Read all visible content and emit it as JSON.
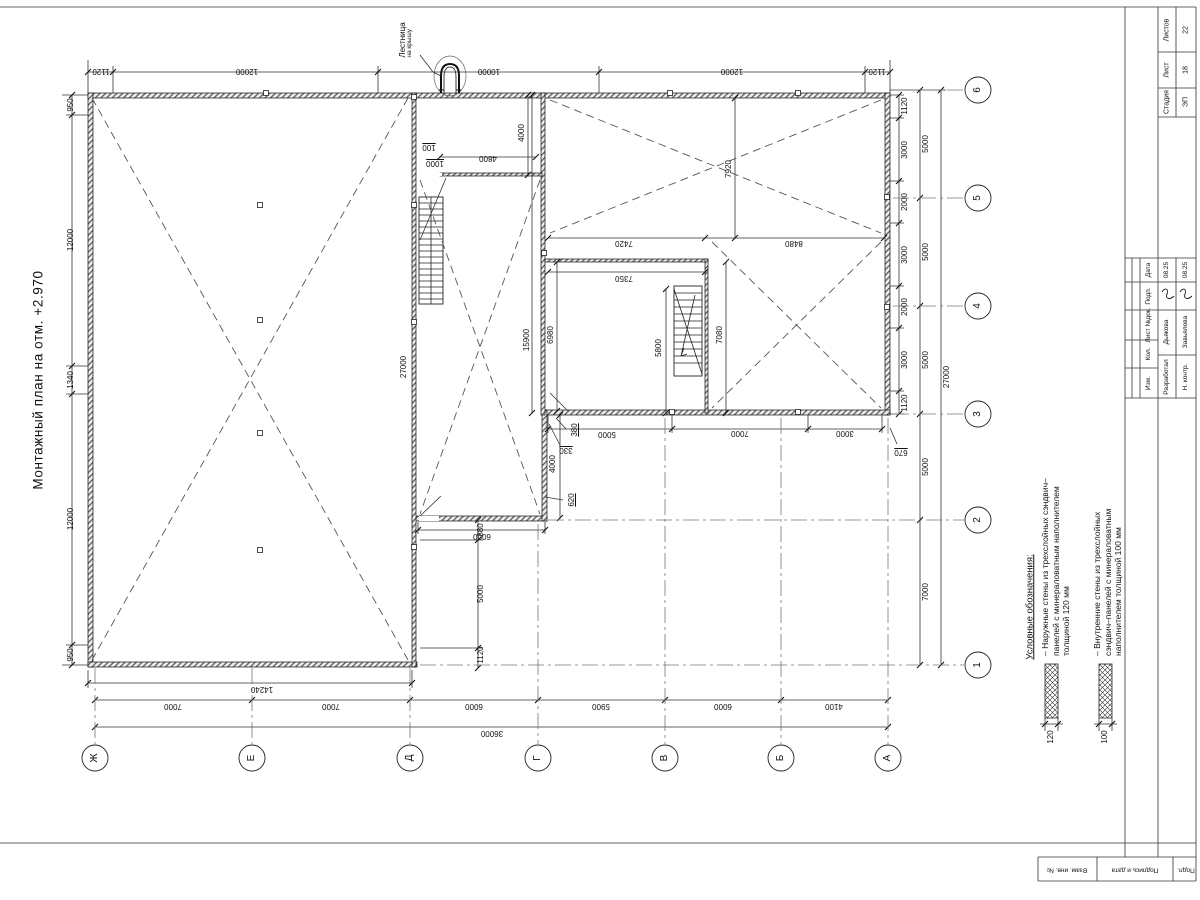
{
  "title": "Монтажный план на отм. +2.970",
  "ladder_note": {
    "line1": "Лестница",
    "line2": "на крышу"
  },
  "axes": {
    "numbers": [
      "6",
      "5",
      "4",
      "3",
      "2",
      "1"
    ],
    "letters": [
      "Ж",
      "Е",
      "Д",
      "Г",
      "В",
      "Б",
      "А"
    ]
  },
  "dims": {
    "top": [
      "1120",
      "12000",
      "10000",
      "12000",
      "1120"
    ],
    "left": [
      "950",
      "12000",
      "1340",
      "12000",
      "950"
    ],
    "right_inner": [
      "1120",
      "3000",
      "2000",
      "3000",
      "2000",
      "3000",
      "1120"
    ],
    "right_outer": [
      "5000",
      "5000",
      "5000",
      "5000",
      "7000"
    ],
    "right_total": "27000",
    "bottom": [
      "7000",
      "7000",
      "6000",
      "5900",
      "6000",
      "4100"
    ],
    "bottom_total": "36000",
    "bottom_partial": "14240",
    "interior": {
      "corridor_total": "27000",
      "room_depth": "4000",
      "room_width": "4800",
      "wall_100": "100",
      "offset_1000": "1000",
      "wing_depth": "15900",
      "bay_7920": "7920",
      "span_7420": "7420",
      "span_8480": "8480",
      "room_7350": "7350",
      "room_6980": "6980",
      "stair_5800": "5800",
      "room_7080": "7080",
      "offset_380": "380",
      "offset_330": "330",
      "opening_4000": "4000",
      "door_620": "620",
      "span_5000": "5000",
      "corridor_6000": "6000",
      "span_7000": "7000",
      "span_3000": "3000",
      "offset_670": "670",
      "offset_880": "880",
      "span_5000_left": "5000",
      "offset_1120": "1120"
    }
  },
  "legend": {
    "header": "Условные обозначения:",
    "items": [
      {
        "text": "– Наружные стены из трехслойных сэндвич–панелей с минераловатным наполнителем толщиной 120 мм",
        "thickness": "120"
      },
      {
        "text": "– Внутренние стены из трехслойных сэндвич–панелей с минераловатным наполнителем толщиной 100 мм",
        "thickness": "100"
      }
    ]
  },
  "title_block": {
    "stage_label": "Стадия",
    "stage": "ЭП",
    "sheet_label": "Лист",
    "sheet": "18",
    "sheets_label": "Листов",
    "sheets": "22",
    "header_cells": [
      "Дата",
      "Подп.",
      "Лист №док.",
      "Кол.",
      "Изм."
    ],
    "rows": [
      {
        "role": "Разработал",
        "name": "Дьякова",
        "date": "08.25"
      },
      {
        "role": "Н. контр.",
        "name": "Завьялова",
        "date": "08.25"
      }
    ],
    "side_strip": [
      "Взам. инв. №",
      "Подпись и дата",
      "Подл."
    ]
  }
}
